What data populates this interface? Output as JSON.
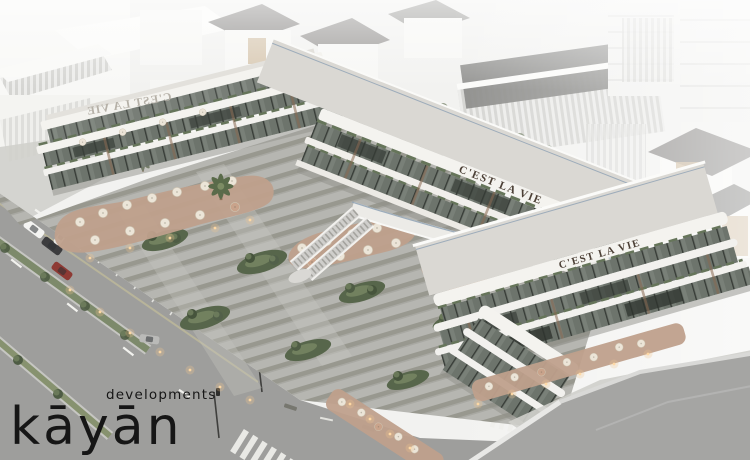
{
  "brand": {
    "name": "kayan",
    "wordmark": "kāyān",
    "tagline": "developments",
    "text_color": "#161616"
  },
  "signage": {
    "label": "C'EST LA VIE",
    "front_color": "#4c4036",
    "back_color": "#b5b0a7"
  },
  "scene": {
    "type": "architectural-aerial-rendering",
    "visible_texts": [
      "kayan",
      "developments",
      "C'EST LA VIE"
    ]
  },
  "palette": {
    "fog": "#f2f2f0",
    "bg_building": "#f7f7f5",
    "bg_roof_dark": "#73716f",
    "bg_wood": "#c9b190",
    "mall_white": "#f4f3ef",
    "roof_deck": "#dad8d3",
    "glass": "#6d746c",
    "glass_dark": "#3a403a",
    "railing": "#8fa2b4",
    "plaza_light": "#b6b6b1",
    "plaza_dark": "#98988f",
    "patio": "#bfa08c",
    "green_dark": "#4e5c44",
    "green_light": "#72815f",
    "road": "#9e9e9c",
    "road_marking": "#f2f2ee",
    "median_green": "#7d8a6b",
    "warm_light": "#f2c68f",
    "umbrella_cream": "#ece5d8",
    "umbrella_terra": "#c9a38b",
    "foreground_roof": "#a5a5a3",
    "bronze_fin": "#8a6a52",
    "car_white": "#f4f4f2",
    "car_dark": "#3c3c3e",
    "car_red": "#8e3a34"
  }
}
